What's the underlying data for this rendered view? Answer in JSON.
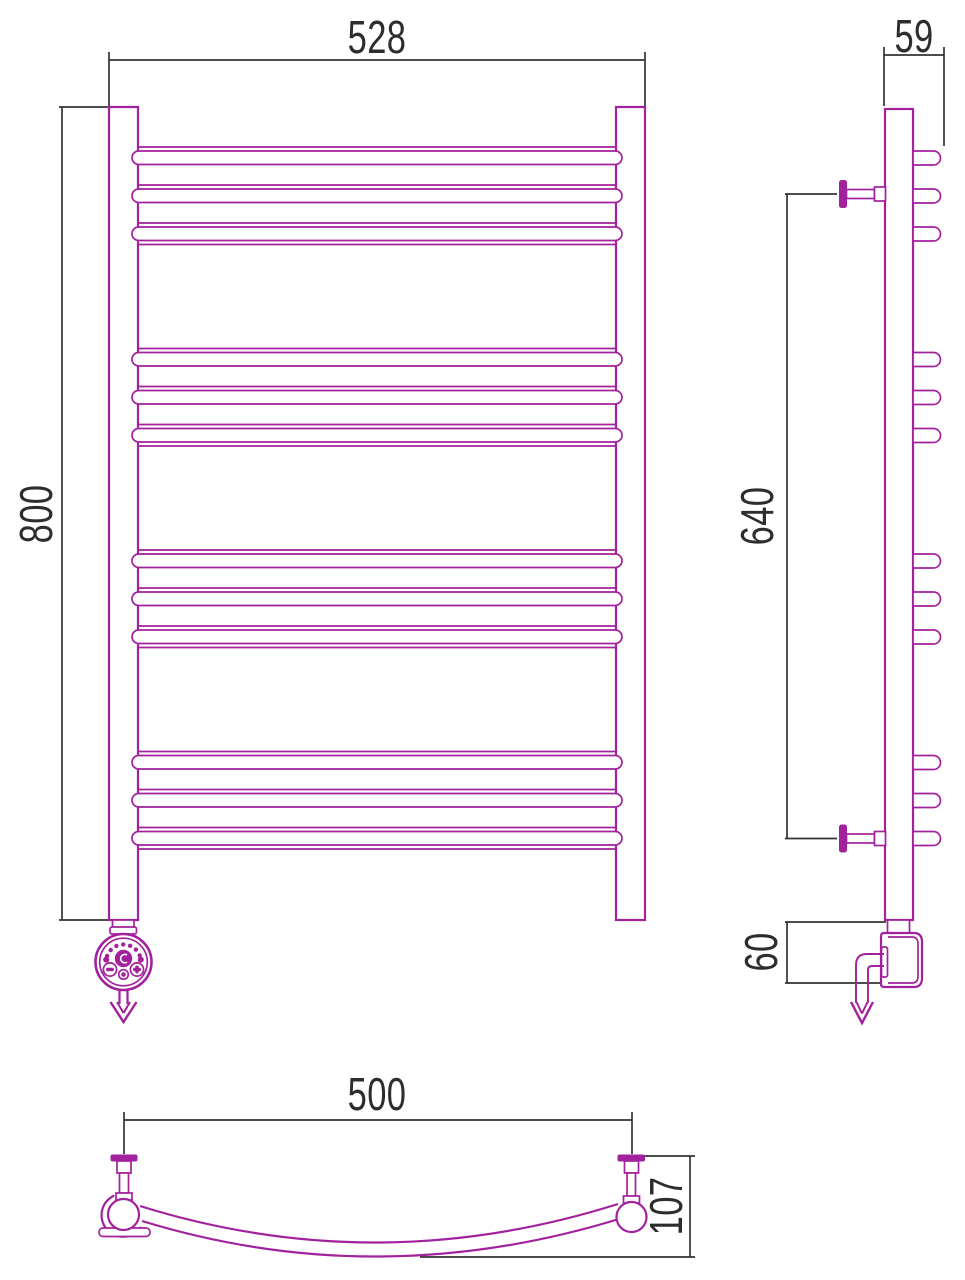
{
  "meta": {
    "drawing_type": "technical dimension drawing",
    "subject": "curved ladder towel rail with electric heating element, three orthographic views"
  },
  "colors": {
    "product_outline": "#a2219c",
    "dimension_lines": "#333333",
    "label_text": "#2d2d2d",
    "background": "#ffffff"
  },
  "dimensions": {
    "front_width": "528",
    "front_height": "800",
    "side_depth": "59",
    "side_mount_span": "640",
    "side_bottom_offset": "60",
    "plan_mount_width": "500",
    "plan_depth": "107"
  }
}
